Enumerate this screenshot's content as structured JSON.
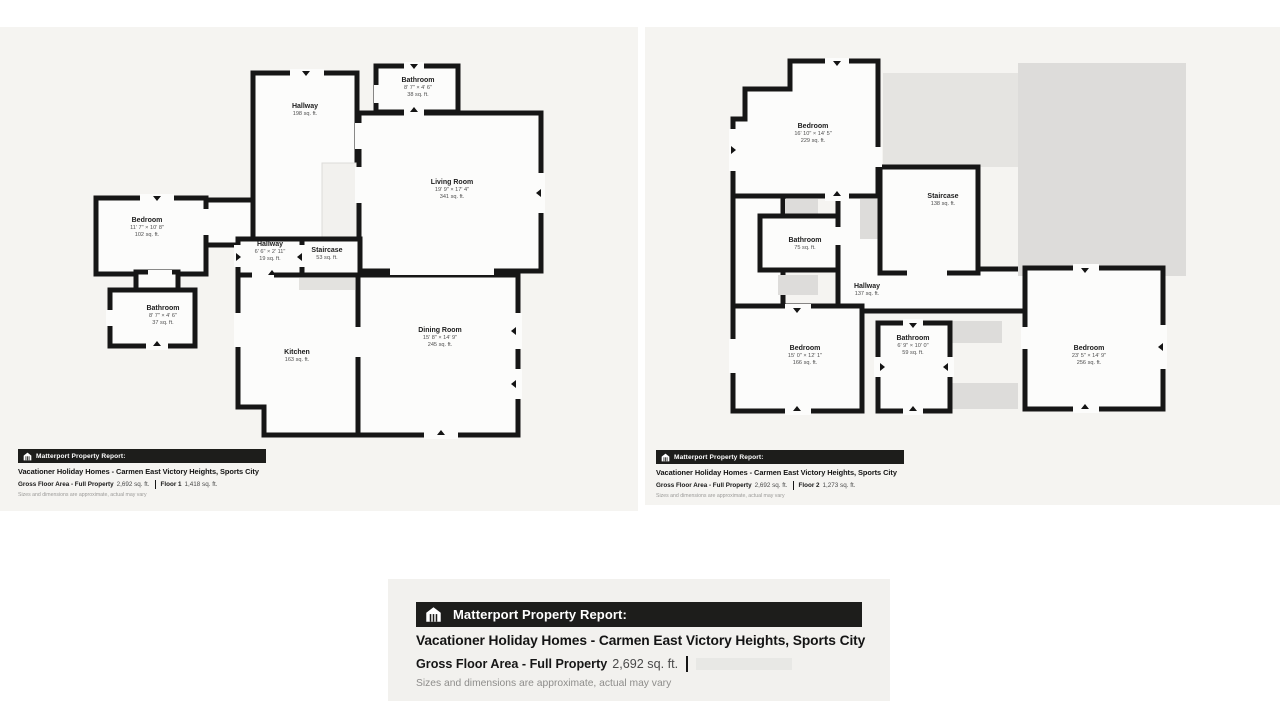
{
  "floor1": {
    "rooms": [
      {
        "name": "Hallway",
        "area": "198 sq. ft."
      },
      {
        "name": "Bathroom",
        "dims": "8' 7\" × 4' 6\"",
        "area": "38 sq. ft."
      },
      {
        "name": "Living Room",
        "dims": "19' 9\" × 17' 4\"",
        "area": "341 sq. ft."
      },
      {
        "name": "Bedroom",
        "dims": "11' 7\" × 10' 8\"",
        "area": "102 sq. ft."
      },
      {
        "name": "Hallway",
        "dims": "6' 6\" × 2' 11\"",
        "area": "19 sq. ft."
      },
      {
        "name": "Staircase",
        "area": "53 sq. ft."
      },
      {
        "name": "Bathroom",
        "dims": "8' 7\" × 4' 6\"",
        "area": "37 sq. ft."
      },
      {
        "name": "Kitchen",
        "area": "163 sq. ft."
      },
      {
        "name": "Dining Room",
        "dims": "15' 8\" × 14' 9\"",
        "area": "245 sq. ft."
      }
    ],
    "report": {
      "bar_label": "Matterport Property Report:",
      "title": "Vacationer Holiday Homes - Carmen East Victory Heights, Sports City",
      "gross_label": "Gross Floor Area - Full Property",
      "gross_value": "2,692 sq. ft.",
      "floor_label": "Floor 1",
      "floor_value": "1,418 sq. ft.",
      "disclaimer": "Sizes and dimensions are approximate, actual may vary"
    }
  },
  "floor2": {
    "rooms": [
      {
        "name": "Bedroom",
        "dims": "16' 10\" × 14' 5\"",
        "area": "229 sq. ft."
      },
      {
        "name": "Staircase",
        "area": "138 sq. ft."
      },
      {
        "name": "Bathroom",
        "area": "75 sq. ft."
      },
      {
        "name": "Hallway",
        "area": "137 sq. ft."
      },
      {
        "name": "Bedroom",
        "dims": "15' 0\" × 12' 1\"",
        "area": "166 sq. ft."
      },
      {
        "name": "Bathroom",
        "dims": "6' 9\" × 10' 0\"",
        "area": "59 sq. ft."
      },
      {
        "name": "Bedroom",
        "dims": "23' 5\" × 14' 9\"",
        "area": "256 sq. ft."
      }
    ],
    "report": {
      "bar_label": "Matterport Property Report:",
      "title": "Vacationer Holiday Homes - Carmen East Victory Heights, Sports City",
      "gross_label": "Gross Floor Area - Full Property",
      "gross_value": "2,692 sq. ft.",
      "floor_label": "Floor 2",
      "floor_value": "1,273 sq. ft.",
      "disclaimer": "Sizes and dimensions are approximate, actual may vary"
    }
  },
  "summary": {
    "report": {
      "bar_label": "Matterport Property Report:",
      "title": "Vacationer Holiday Homes - Carmen East Victory Heights, Sports City",
      "gross_label": "Gross Floor Area - Full Property",
      "gross_value": "2,692 sq. ft.",
      "disclaimer": "Sizes and dimensions are approximate, actual may vary"
    }
  },
  "colors": {
    "wall": "#161616",
    "panel_bg": "#f5f4f1",
    "report_bar_bg": "#1d1d1b",
    "gray_area": "#dddcda"
  }
}
